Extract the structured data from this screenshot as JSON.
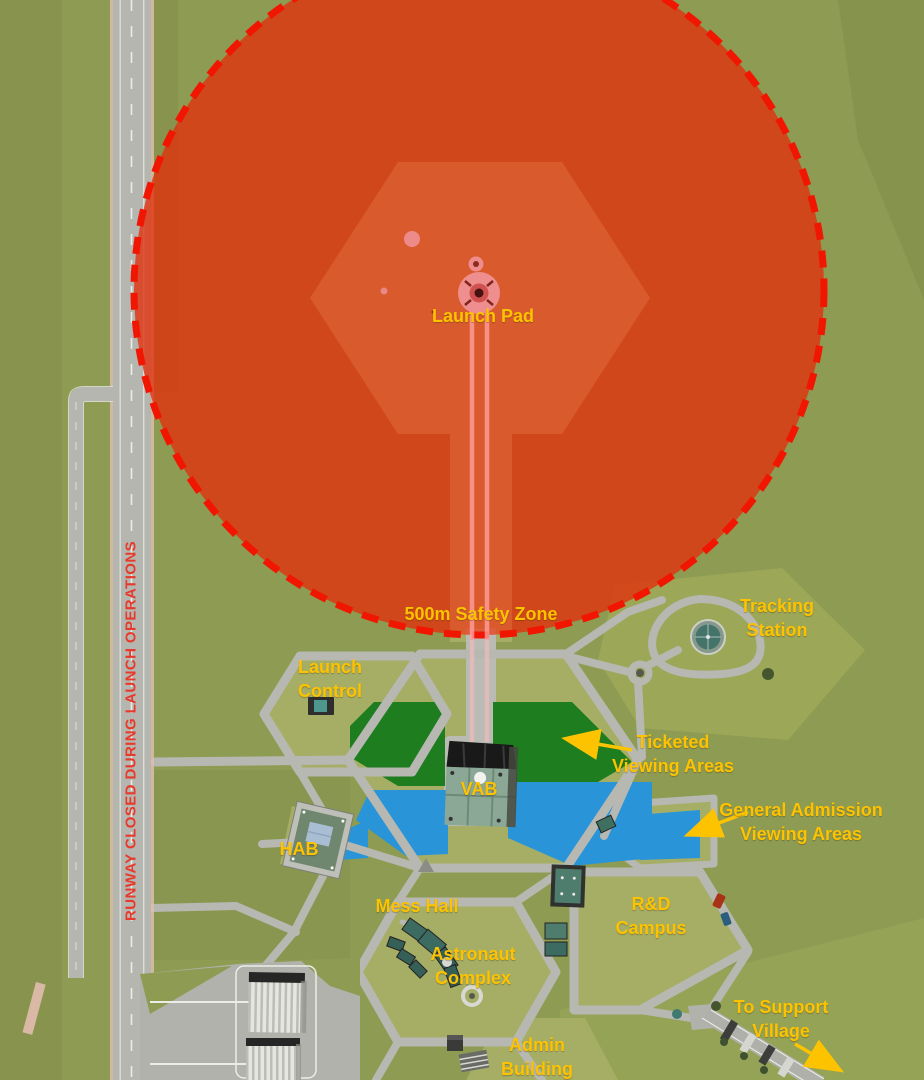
{
  "colors": {
    "label_yellow": "#fdc300",
    "warning_red": "#e8392b",
    "safety_zone_fill": "#d9441c",
    "safety_zone_border": "#f01602",
    "ticketed_green": "#1e7d1f",
    "general_admission_blue": "#2a94d8",
    "terrain_green": "#8e9b52",
    "road_gray": "#b6b8b1"
  },
  "map": {
    "launch_pad_label": "Launch Pad",
    "safety_zone_label": "500m Safety Zone",
    "runway_notice": "RUNWAY CLOSED DURING LAUNCH OPERATIONS",
    "tracking_station": {
      "line1": "Tracking",
      "line2": "Station"
    },
    "launch_control": {
      "line1": "Launch",
      "line2": "Control"
    },
    "ticketed_viewing": {
      "line1": "Ticketed",
      "line2": "Viewing Areas"
    },
    "general_admission": {
      "line1": "General Admission",
      "line2": "Viewing Areas"
    },
    "hab_label": "HAB",
    "vab_label": "VAB",
    "mess_hall_label": "Mess Hall",
    "astronaut_complex": {
      "line1": "Astronaut",
      "line2": "Complex"
    },
    "rnd_campus": {
      "line1": "R&D",
      "line2": "Campus"
    },
    "admin_building": {
      "line1": "Admin",
      "line2": "Building"
    },
    "to_support_village": {
      "line1": "To Support",
      "line2": "Village"
    }
  }
}
